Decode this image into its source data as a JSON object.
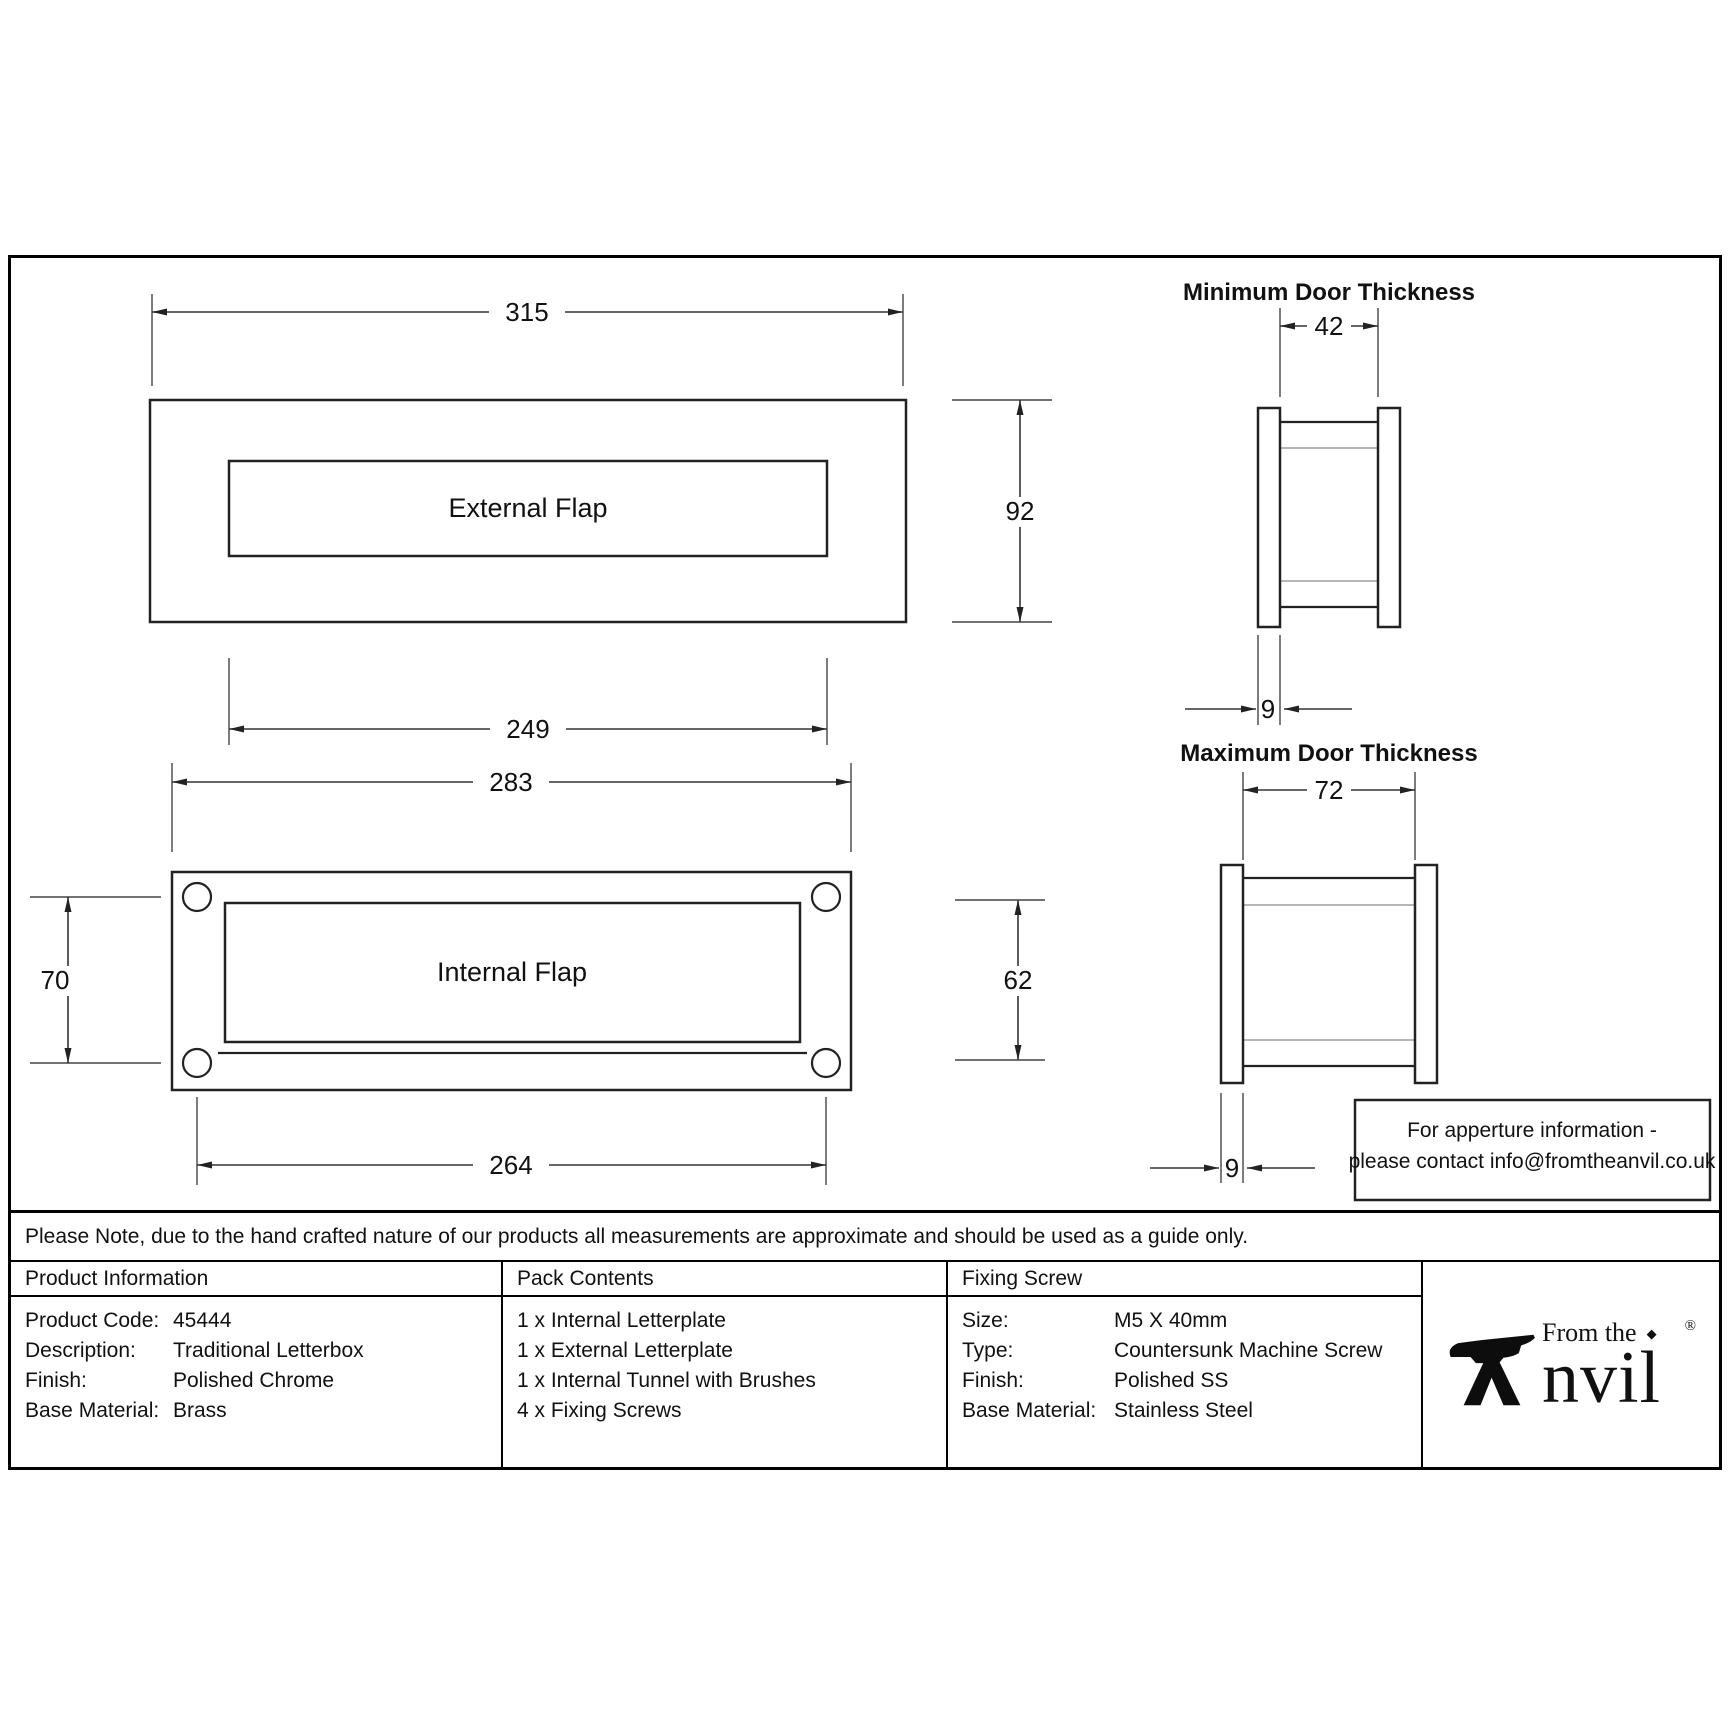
{
  "drawing": {
    "external": {
      "label": "External Flap",
      "width_dim": "315",
      "flap_width_dim": "249",
      "height_dim": "92"
    },
    "internal": {
      "label": "Internal Flap",
      "width_dim": "283",
      "fixing_width_dim": "264",
      "fixing_height_dim": "70",
      "flap_height_dim": "62"
    },
    "min_door": {
      "title": "Minimum Door Thickness",
      "thickness_dim": "42",
      "plate_dim": "9"
    },
    "max_door": {
      "title": "Maximum Door Thickness",
      "thickness_dim": "72",
      "plate_dim": "9"
    },
    "note_box": {
      "line1": "For apperture information -",
      "line2": "please contact info@fromtheanvil.co.uk"
    }
  },
  "disclaimer": "Please Note, due to the hand crafted nature of our products all measurements are approximate and should be used as a guide only.",
  "table": {
    "product_information": {
      "header": "Product Information",
      "rows": [
        {
          "label": "Product Code:",
          "value": "45444"
        },
        {
          "label": "Description:",
          "value": "Traditional Letterbox"
        },
        {
          "label": "Finish:",
          "value": "Polished Chrome"
        },
        {
          "label": "Base Material:",
          "value": "Brass"
        }
      ]
    },
    "pack_contents": {
      "header": "Pack Contents",
      "items": [
        "1 x Internal Letterplate",
        "1 x External Letterplate",
        "1 x Internal Tunnel with Brushes",
        "4 x Fixing Screws"
      ]
    },
    "fixing_screw": {
      "header": "Fixing Screw",
      "rows": [
        {
          "label": "Size:",
          "value": "M5 X 40mm"
        },
        {
          "label": "Type:",
          "value": "Countersunk Machine Screw"
        },
        {
          "label": "Finish:",
          "value": "Polished SS"
        },
        {
          "label": "Base Material:",
          "value": "Stainless Steel"
        }
      ]
    },
    "logo": {
      "prefix": "From the",
      "name": "nvil",
      "diamond": "◆",
      "registered": "®"
    }
  }
}
